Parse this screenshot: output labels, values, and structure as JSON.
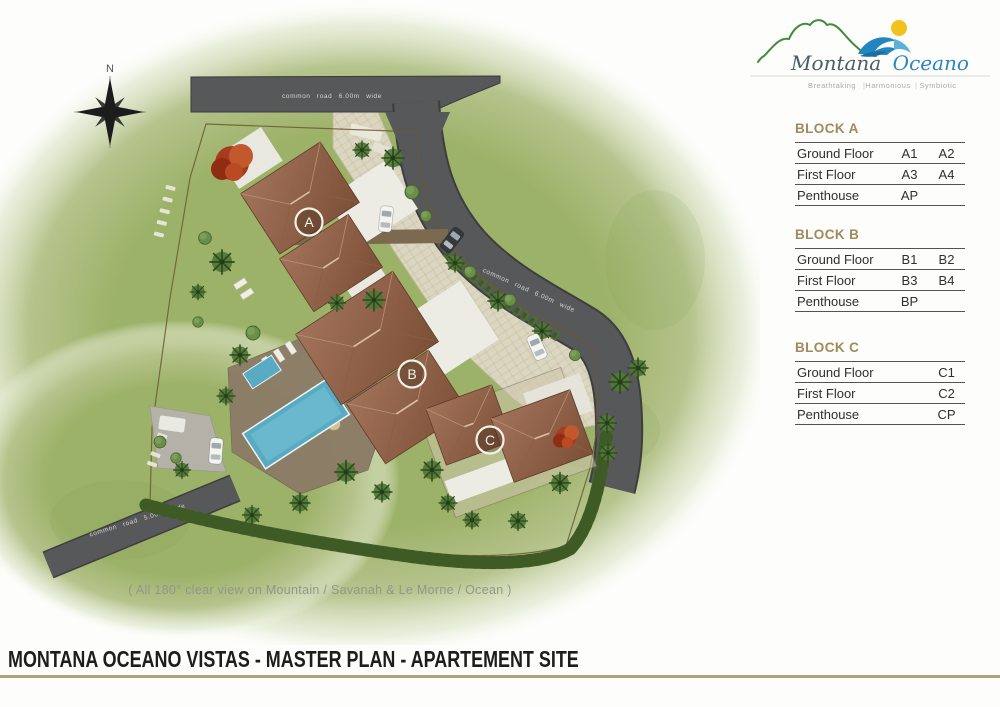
{
  "logo": {
    "name_primary": "Montana",
    "name_secondary": "Oceano",
    "separator": "|",
    "taglines": [
      "Breathtaking",
      "Harmonious",
      "Symbiotic"
    ]
  },
  "compass": {
    "north_label": "N"
  },
  "plan": {
    "road_labels": {
      "north": "common road 6.00m wide",
      "east": "common road 6.00m wide",
      "southwest": "common road 5.00m wide"
    },
    "building_markers": [
      {
        "id": "A"
      },
      {
        "id": "B"
      },
      {
        "id": "C"
      }
    ],
    "caption": "( All 180° clear view on Mountain / Savanah & Le Morne / Ocean )"
  },
  "blocks": [
    {
      "title": "BLOCK A",
      "rows": [
        {
          "label": "Ground Floor",
          "units": [
            "A1",
            "A2"
          ]
        },
        {
          "label": "First Floor",
          "units": [
            "A3",
            "A4"
          ]
        },
        {
          "label": "Penthouse",
          "units": [
            "AP",
            ""
          ]
        }
      ]
    },
    {
      "title": "BLOCK B",
      "rows": [
        {
          "label": "Ground Floor",
          "units": [
            "B1",
            "B2"
          ]
        },
        {
          "label": "First Floor",
          "units": [
            "B3",
            "B4"
          ]
        },
        {
          "label": "Penthouse",
          "units": [
            "BP",
            ""
          ]
        }
      ]
    },
    {
      "title": "BLOCK C",
      "rows": [
        {
          "label": "Ground Floor",
          "units": [
            "",
            "C1"
          ]
        },
        {
          "label": "First Floor",
          "units": [
            "",
            "C2"
          ]
        },
        {
          "label": "Penthouse",
          "units": [
            "",
            "CP"
          ]
        }
      ]
    }
  ],
  "footer": {
    "title": "MONTANA OCEANO VISTAS - MASTER PLAN - APARTEMENT SITE"
  }
}
